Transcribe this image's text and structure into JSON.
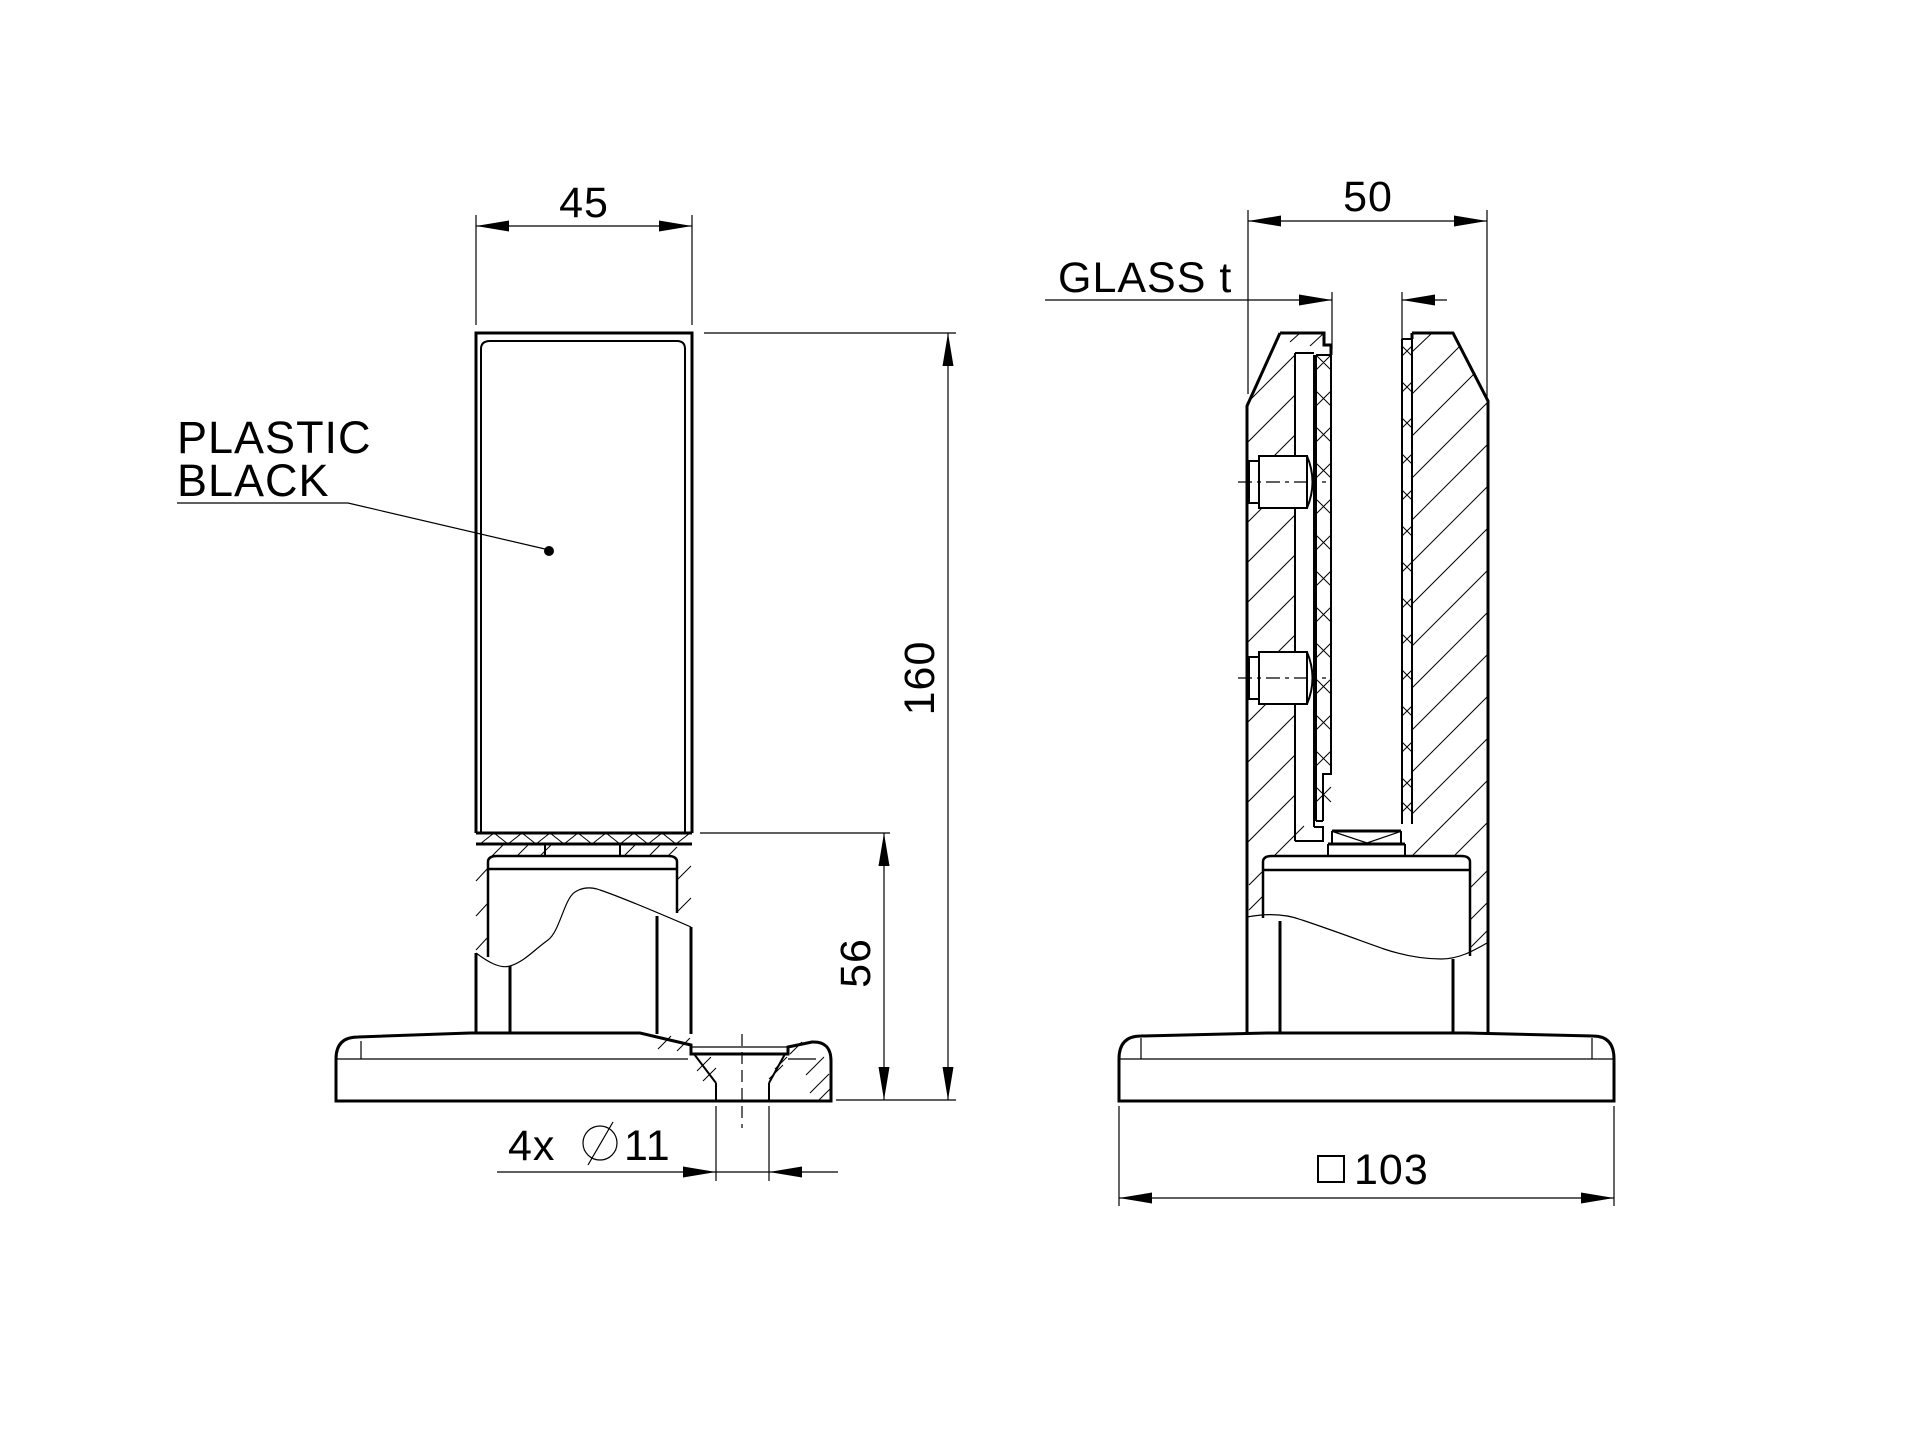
{
  "colors": {
    "background": "#ffffff",
    "line": "#000000",
    "text": "#000000"
  },
  "front_view": {
    "width_dim": "45",
    "height_dim": "160",
    "base_height_dim": "56",
    "material_line1": "PLASTIC",
    "material_line2": "BLACK",
    "hole_dim_prefix": "4x",
    "hole_dim_symbol": "⌀",
    "hole_dim_value": "11"
  },
  "side_view": {
    "width_dim": "50",
    "glass_label": "GLASS t",
    "base_dim_symbol": "□",
    "base_dim_value": "103"
  }
}
